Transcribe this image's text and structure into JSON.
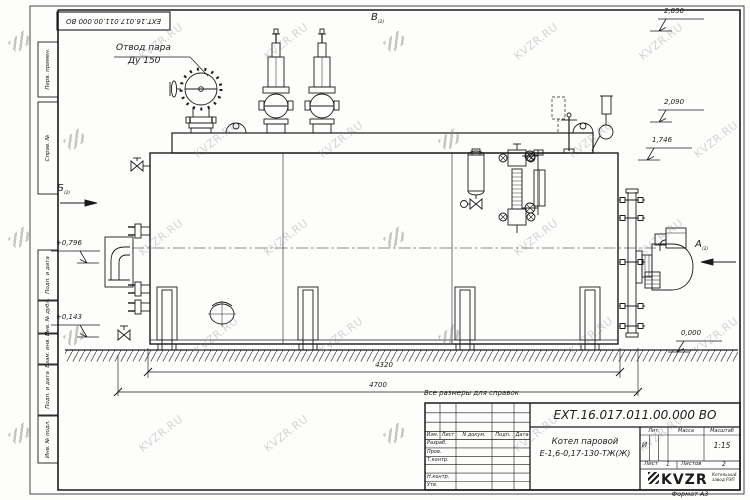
{
  "watermark": {
    "text": "KVZR.RU"
  },
  "frame": {
    "top_stamp": "ЕХТ.16.017.011.00.000  ВО",
    "margin_labels": [
      "Перв. примен.",
      "Справ. №",
      "Подп. и дата",
      "Инв. № дубл.",
      "Взам. инв. №",
      "Подп. и дата",
      "Инв. № подл."
    ],
    "format_label": "Формат А3"
  },
  "drawing": {
    "callout_steam_1": "Отвод пара",
    "callout_steam_2": "Ду 150",
    "view_a": "А",
    "view_b": "Б",
    "view_v": "В",
    "view_sheet_ref": "(2)",
    "elev_1": "2,850",
    "elev_2": "2,090",
    "elev_3": "1,746",
    "elev_4": "+0,796",
    "elev_5": "+0,143",
    "elev_ground": "0,000",
    "dim_inner": "4320",
    "dim_outer": "4700",
    "note": "Все размеры для справок"
  },
  "title_block": {
    "doc_number": "ЕХТ.16.017.011.00.000  ВО",
    "product_name": "Котел паровой",
    "product_model": "Е-1,6-0,17-130-ТЖ(Ж)",
    "hdr_izm": "Изм.",
    "hdr_list": "Лист",
    "hdr_ndoc": "N докум.",
    "hdr_podp": "Подп.",
    "hdr_data": "Дата",
    "row_razrab": "Разраб.",
    "row_prov": "Пров.",
    "row_tkontr": "Т.контр.",
    "row_nkontr": "Н.контр.",
    "row_utv": "Утв.",
    "lit_header": "Лит.",
    "mass_header": "Масса",
    "scale_header": "Масштаб",
    "lit_value": "И",
    "scale_value": "1:15",
    "sheet_label": "Лист",
    "sheet_value": "1",
    "sheets_label": "Листов",
    "sheets_value": "2",
    "company_logo": "KVZR",
    "company_line1": "Котельный",
    "company_line2": "завод РЭП"
  }
}
